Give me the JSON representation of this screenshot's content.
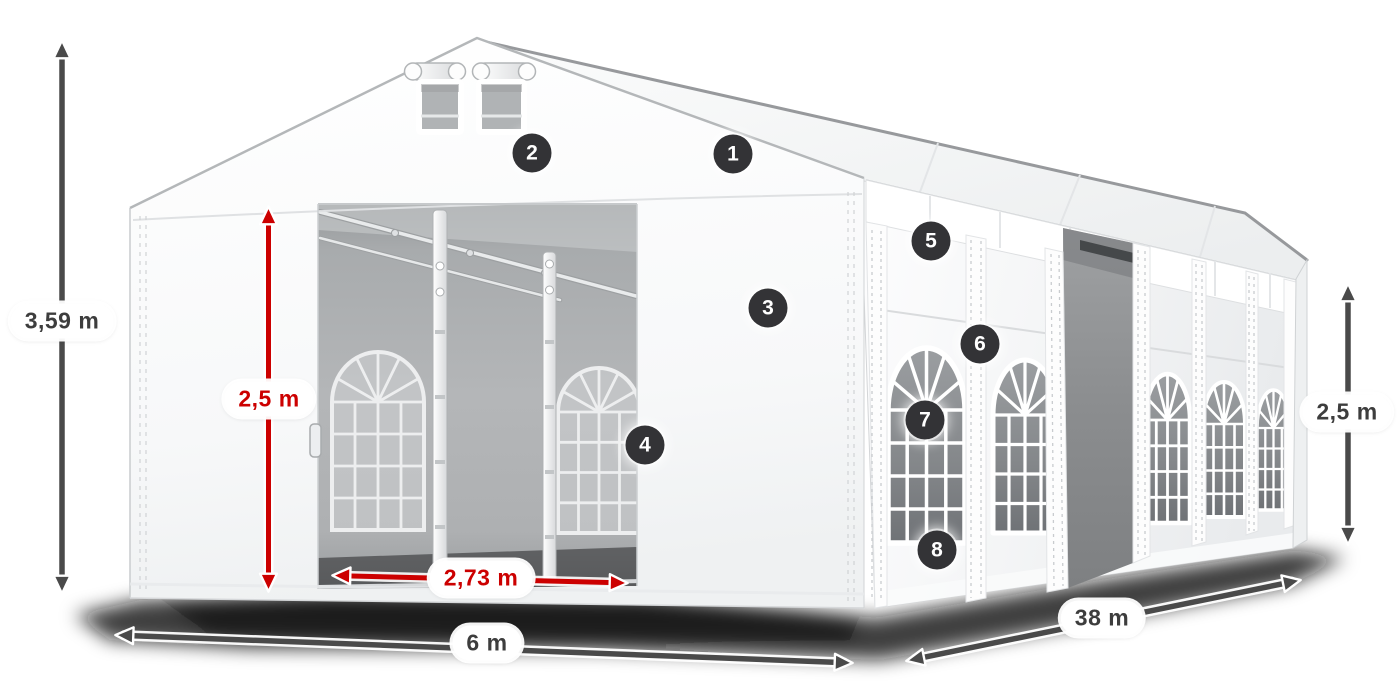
{
  "figure": {
    "alt": "White tent with open front entrance, gable vents, side wall with arched windows and open side door, annotated with dimension arrows and numbered callouts"
  },
  "colors": {
    "dimension_red": "#cc0000",
    "dimension_gray": "#4a4a4a",
    "badge_background": "#333336",
    "pill_background": "#ffffff",
    "pill_text": "#3d3d3d"
  },
  "dimensions": {
    "total_height": "3,59 m",
    "entrance_height": "2,5 m",
    "entrance_width": "2,73 m",
    "front_width": "6 m",
    "length": "38 m",
    "side_height": "2,5 m"
  },
  "markers": [
    {
      "label": "1"
    },
    {
      "label": "2"
    },
    {
      "label": "3"
    },
    {
      "label": "4"
    },
    {
      "label": "5"
    },
    {
      "label": "6"
    },
    {
      "label": "7"
    },
    {
      "label": "8"
    }
  ]
}
